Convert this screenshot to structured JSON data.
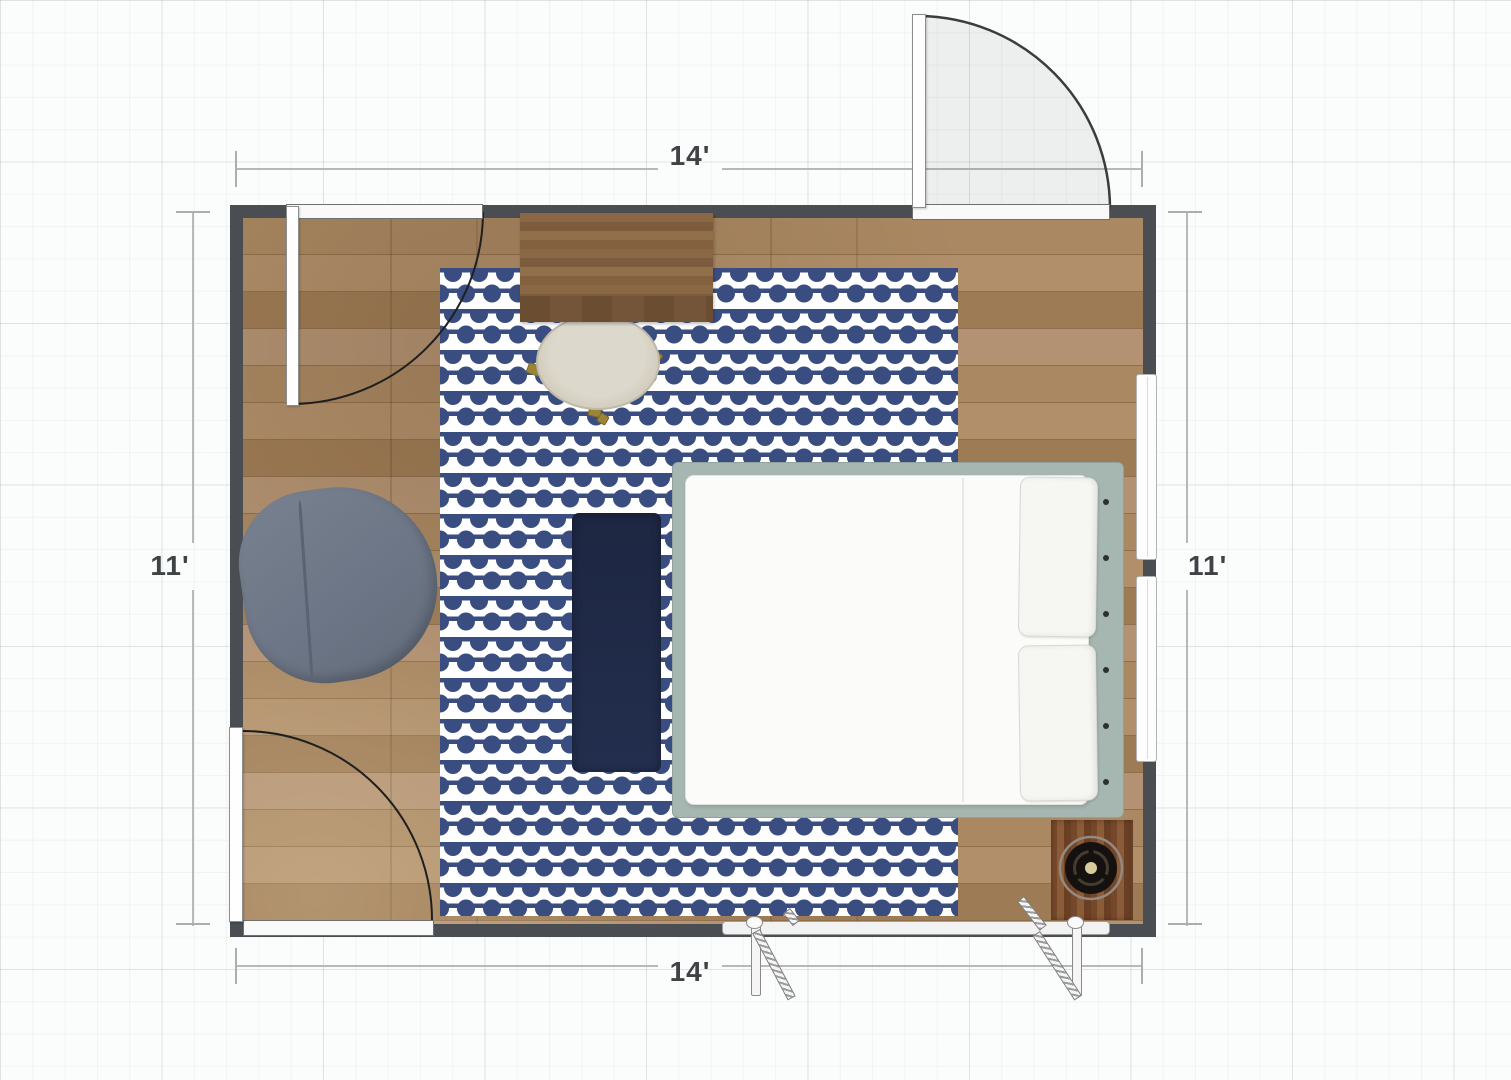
{
  "dimensions": {
    "top": {
      "label": "14'"
    },
    "bottom": {
      "label": "14'"
    },
    "left": {
      "label": "11'"
    },
    "right": {
      "label": "11'"
    }
  },
  "colors": {
    "grid_bg": "#fbfcfc",
    "wall": "#4a4e52",
    "floor_wood": "#a98862",
    "rug_navy": "#3a4d80",
    "rug_white": "#ffffff",
    "runner_navy": "#1d2742",
    "bed_frame": "#a6b6b1",
    "mattress": "#fbfbfa",
    "armchair": "#6d7686",
    "desk_wood": "#83613f",
    "chair_cream": "#d8d4c6",
    "speaker_wood": "#76482b",
    "brass": "#9a8438",
    "dimension_text": "#3f4345"
  }
}
